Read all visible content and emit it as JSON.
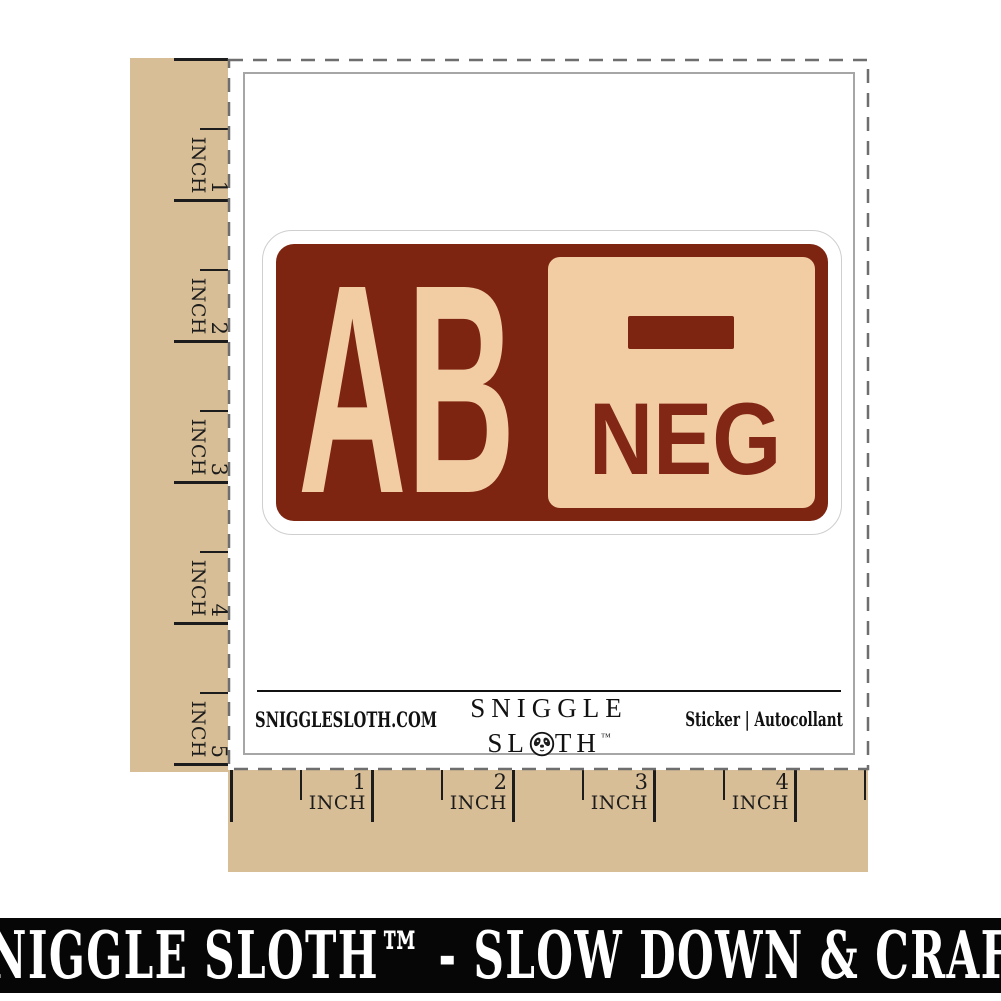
{
  "sticker": {
    "blood_type": "AB",
    "rh_label": "NEG",
    "rh_symbol_icon": "minus-icon",
    "colors": {
      "maroon": "#7E2511",
      "cream": "#F2CDA4"
    }
  },
  "sheet_footer": {
    "website": "SNIGGLESLOTH.COM",
    "brand_line1": "SNIGGLE",
    "brand_line2_prefix": "SL",
    "brand_line2_suffix": "TH",
    "trademark": "™",
    "product_type": "Sticker | Autocollant"
  },
  "rulers": {
    "unit": "INCH",
    "left_numbers": [
      "1",
      "2",
      "3",
      "4",
      "5"
    ],
    "bottom_numbers": [
      "1",
      "2",
      "3",
      "4"
    ],
    "background": "#D8BE96"
  },
  "banner": {
    "text": "SNIGGLE SLOTH™ - SLOW DOWN & CRAFT"
  }
}
